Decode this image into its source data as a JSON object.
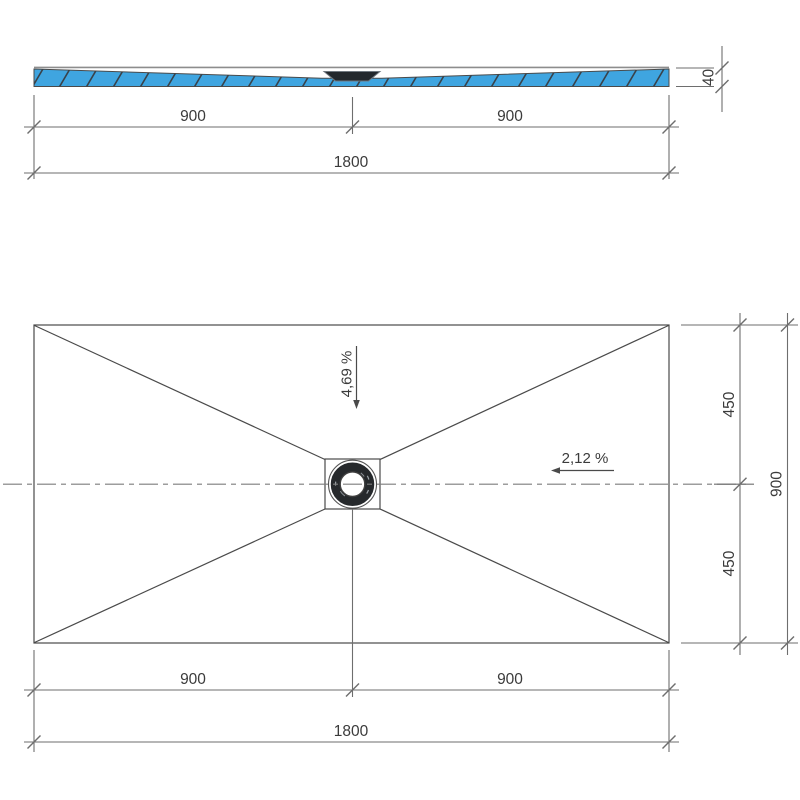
{
  "colors": {
    "tray_blue": "#3FA5E0",
    "hatch": "#39424a",
    "rim_gray": "#8d8d8d",
    "line_dark": "#4a4a4a",
    "line_dim": "#6e6e6e",
    "line_center": "#7d7d7d",
    "drain_dark": "#23282d",
    "text": "#3b3b3b"
  },
  "section_view": {
    "thickness": "40",
    "dim_left_half": "900",
    "dim_right_half": "900",
    "dim_total": "1800"
  },
  "plan_view": {
    "slope_vertical": "4,69 %",
    "slope_horizontal": "2,12 %",
    "dim_top_half": "450",
    "dim_bottom_half": "450",
    "dim_side_total": "900",
    "dim_left_half": "900",
    "dim_right_half": "900",
    "dim_total": "1800"
  }
}
